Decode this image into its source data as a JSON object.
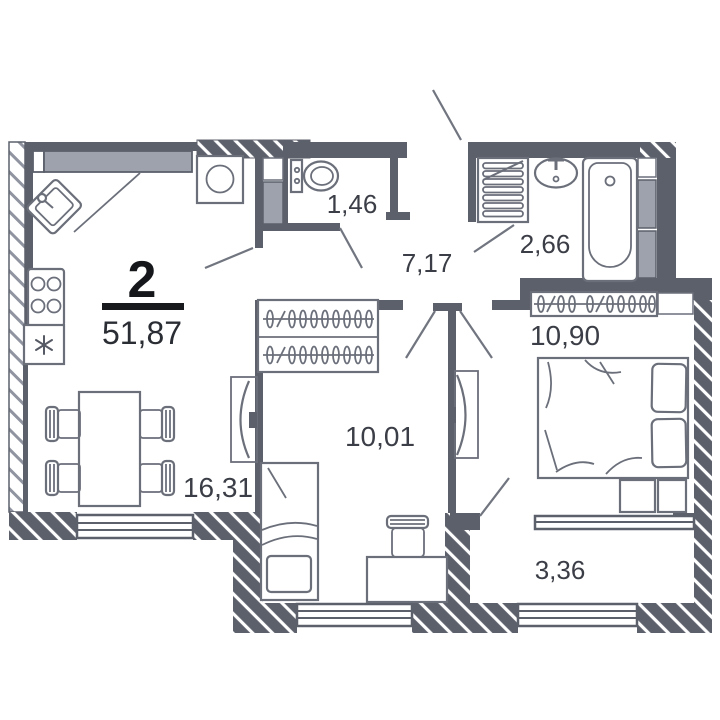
{
  "summary": {
    "rooms_count_label": "2",
    "total_area_label": "51,87"
  },
  "rooms": [
    {
      "name": "kitchen-living-room",
      "area": "16,31"
    },
    {
      "name": "hallway",
      "area": "7,17"
    },
    {
      "name": "wc",
      "area": "1,46"
    },
    {
      "name": "bathroom",
      "area": "2,66"
    },
    {
      "name": "bedroom",
      "area": "10,90"
    },
    {
      "name": "room",
      "area": "10,01"
    },
    {
      "name": "balcony",
      "area": "3,36"
    }
  ],
  "colors": {
    "wall": "#5c606b",
    "shaft": "#9da2ac",
    "label_text": "#3b3e46",
    "title_text": "#15171b",
    "background": "#ffffff"
  }
}
